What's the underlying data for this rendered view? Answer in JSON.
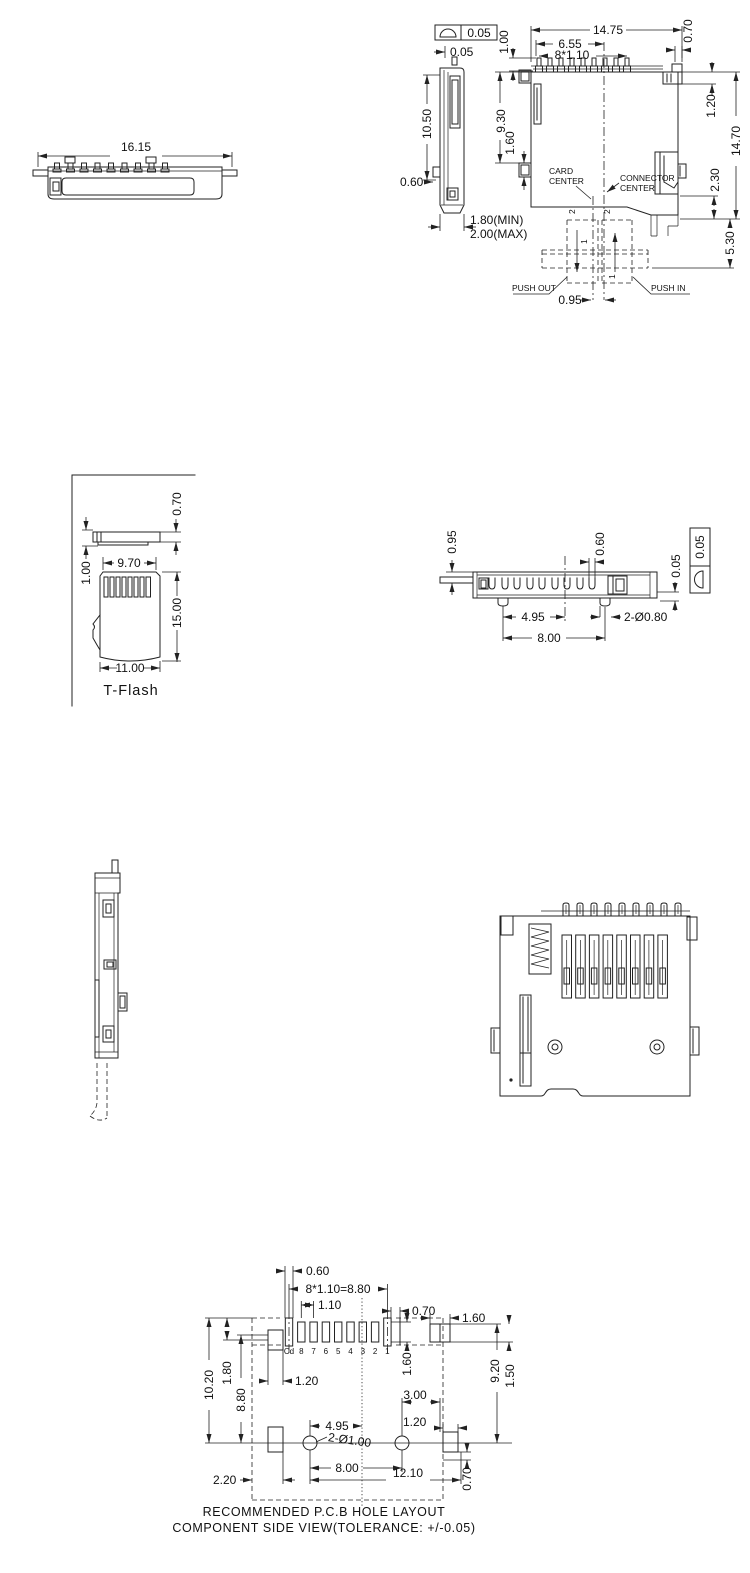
{
  "front_view": {
    "width": "16.15"
  },
  "side_profile": {
    "flatness": "0.05",
    "top_offset": "0.05",
    "height": "10.50",
    "tab": "0.60",
    "thickness_min": "1.80(MIN)",
    "thickness_max": "2.00(MAX)"
  },
  "top_view": {
    "overall_width": "14.75",
    "pin_span": "6.55",
    "pin_pitch": "8*1.10",
    "pin_length": "1.00",
    "depth_to_tab": "9.30",
    "tab_height": "1.60",
    "pin_width": "0.70",
    "shell_offset": "1.20",
    "overall_depth": "14.70",
    "latch_depth": "2.30",
    "card_overhang": "5.30",
    "center_offset": "0.95",
    "card_center_line1": "CARD",
    "card_center_line2": "CENTER",
    "connector_center_line1": "CONNECTOR",
    "connector_center_line2": "CENTER",
    "push_out": "PUSH OUT",
    "push_in": "PUSH IN",
    "pos_label_1": "1",
    "pos_label_2": "2"
  },
  "tflash": {
    "thickness": "0.70",
    "contact_offset": "1.00",
    "top_width": "9.70",
    "length": "15.00",
    "width": "11.00",
    "label": "T-Flash"
  },
  "bottom_view": {
    "standoff": "0.95",
    "lead_width": "0.60",
    "coplanarity": "0.05",
    "flatness": "0.05",
    "peg_offset": "4.95",
    "peg_pitch": "8.00",
    "peg_dia": "2-Ø0.80"
  },
  "pcb": {
    "pad_width": "0.60",
    "pitch_total": "8*1.10=8.80",
    "pitch": "1.10",
    "pad1_offset": "0.70",
    "right_pad_width": "1.60",
    "pad_height": "1.60",
    "right_pad_height": "1.50",
    "depth": "10.20",
    "pad_row_offset": "1.80",
    "span": "8.80",
    "left_pad_width": "1.20",
    "hole_to_pad": "3.00",
    "right_pad2_width": "1.20",
    "right_span": "9.20",
    "hole_offset": "4.95",
    "hole_dia": "2-Ø1.00",
    "hole_pitch": "8.00",
    "overall": "12.10",
    "left_margin": "2.20",
    "bottom_margin": "0.70",
    "pad_labels": [
      "Cd",
      "8",
      "7",
      "6",
      "5",
      "4",
      "3",
      "2",
      "1"
    ],
    "caption_line1": "RECOMMENDED P.C.B HOLE LAYOUT",
    "caption_line2": "COMPONENT SIDE VIEW(TOLERANCE: +/-0.05)"
  }
}
